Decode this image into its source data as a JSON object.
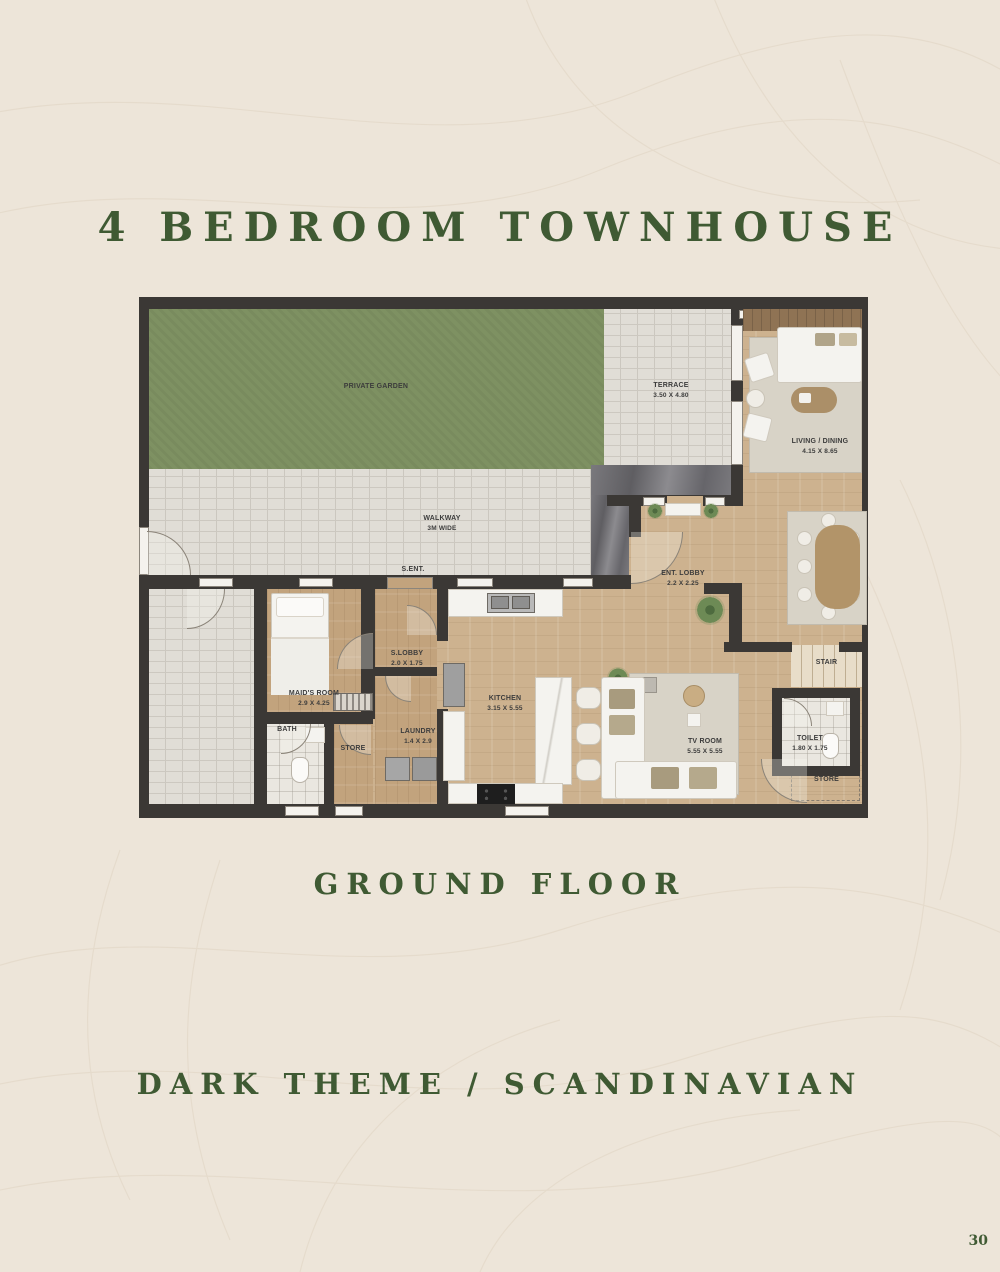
{
  "page": {
    "title": "4 BEDROOM TOWNHOUSE",
    "floor_caption": "GROUND FLOOR",
    "style_caption": "DARK THEME / SCANDINAVIAN",
    "page_number": "30"
  },
  "colors": {
    "background": "#EDE5D9",
    "heading_green": "#3F5A33",
    "wall": "#3B3835",
    "garden_green": "#7E9162",
    "paving": "#E0DDD6",
    "wood_floor": "#CDB28F",
    "wood_floor_dark": "#C2A37D",
    "marble": "#66656A",
    "rug": "#D8D3C7",
    "label_text": "#3C3C3C"
  },
  "plan": {
    "rooms": {
      "garden": {
        "name": "PRIVATE GARDEN"
      },
      "terrace": {
        "name": "TERRACE",
        "dims": "3.50 X 4.80"
      },
      "walkway": {
        "name": "WALKWAY",
        "dims": "3M WIDE"
      },
      "s_ent": {
        "name": "S.ENT."
      },
      "living_dining": {
        "name": "LIVING / DINING",
        "dims": "4.15 X 8.65"
      },
      "ent_lobby": {
        "name": "ENT. LOBBY",
        "dims": "2.2 X 2.25"
      },
      "maids_room": {
        "name": "MAID'S ROOM",
        "dims": "2.9 X 4.25"
      },
      "bath": {
        "name": "BATH"
      },
      "store_1": {
        "name": "STORE"
      },
      "s_lobby": {
        "name": "S.LOBBY",
        "dims": "2.0 X 1.75"
      },
      "laundry": {
        "name": "LAUNDRY",
        "dims": "1.4 X 2.9"
      },
      "kitchen": {
        "name": "KITCHEN",
        "dims": "3.15 X 5.55"
      },
      "tv_room": {
        "name": "TV ROOM",
        "dims": "5.55 X 5.55"
      },
      "toilet": {
        "name": "TOILET",
        "dims": "1.80 X 1.75"
      },
      "stair": {
        "name": "STAIR"
      },
      "store_2": {
        "name": "STORE"
      }
    }
  }
}
